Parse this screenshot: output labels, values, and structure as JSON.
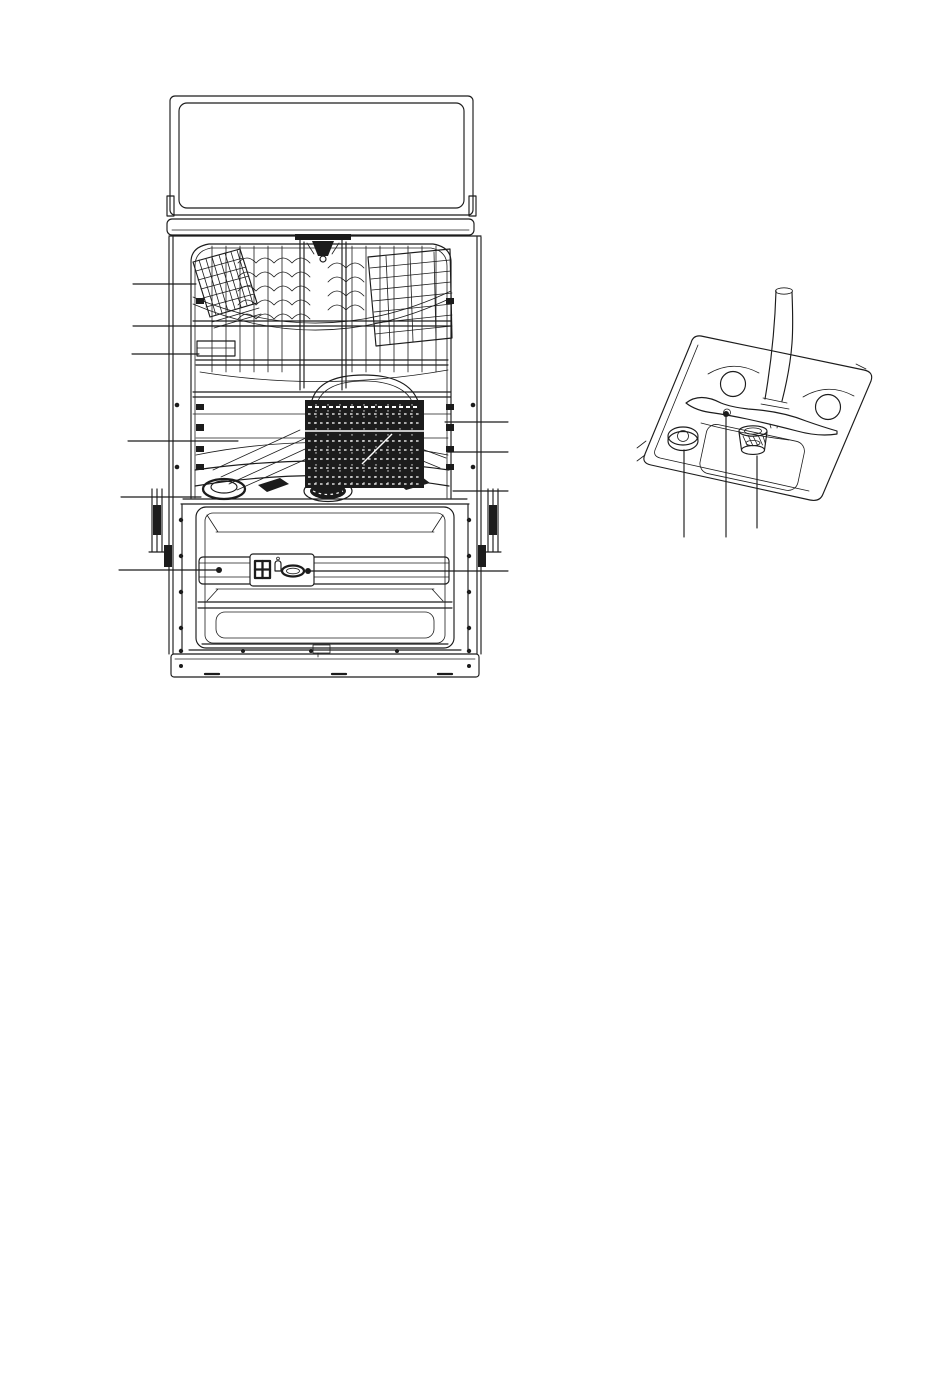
{
  "page": {
    "background": "#ffffff",
    "ink": "#1c1c1c",
    "width": 950,
    "height": 1392
  },
  "figures": {
    "main": {
      "id": "dishwasher-front-view-door-open",
      "parts": [
        "door-top-panel",
        "control-bar",
        "cabinet-sides",
        "tub",
        "top-spray-head",
        "upper-basket",
        "left-plate-rack",
        "right-plate-rack",
        "lower-basket",
        "cutlery-basket",
        "salt-container-cap",
        "filter-hub",
        "door-liner",
        "detergent-dispenser",
        "rinse-aid-cap",
        "plinth"
      ]
    },
    "detail": {
      "id": "sump-and-filter-detail",
      "parts": [
        "base-plate",
        "well-left",
        "well-right",
        "sump-recess",
        "lower-spray-arm",
        "water-inlet-pipe",
        "water-softener-cap",
        "filter-assembly"
      ]
    }
  },
  "callouts": [
    {
      "target": "upper-basket-cup-shelf",
      "from": [
        133,
        284
      ],
      "to": [
        196,
        284
      ]
    },
    {
      "target": "upper-basket-front-rail",
      "from": [
        133,
        326
      ],
      "to": [
        300,
        326
      ]
    },
    {
      "target": "upper-basket-plate-rack",
      "from": [
        132,
        354
      ],
      "to": [
        199,
        354
      ]
    },
    {
      "target": "lower-basket",
      "from": [
        128,
        441
      ],
      "to": [
        238,
        441
      ]
    },
    {
      "target": "salt-container-cap",
      "from": [
        121,
        497
      ],
      "to": [
        201,
        497
      ]
    },
    {
      "target": "detergent-dispenser",
      "from": [
        119,
        570
      ],
      "to": [
        219,
        570
      ],
      "dot": [
        219,
        570
      ]
    },
    {
      "target": "cutlery-basket",
      "from": [
        508,
        422
      ],
      "to": [
        445,
        422
      ]
    },
    {
      "target": "upper-basket-rail-right",
      "from": [
        508,
        452
      ],
      "to": [
        448,
        452
      ]
    },
    {
      "target": "lower-spray-arm-area",
      "from": [
        508,
        491
      ],
      "to": [
        453,
        491
      ]
    },
    {
      "target": "rinse-aid-dispenser",
      "from": [
        508,
        571
      ],
      "to": [
        308,
        571
      ],
      "dot": [
        308,
        571
      ]
    },
    {
      "target": "water-softener-cap-detail",
      "from": [
        684,
        450
      ],
      "to": [
        684,
        537
      ]
    },
    {
      "target": "lower-spray-arm-detail",
      "from": [
        726,
        416
      ],
      "to": [
        726,
        537
      ],
      "dot": [
        726,
        414
      ]
    },
    {
      "target": "filter-detail",
      "from": [
        757,
        456
      ],
      "to": [
        757,
        528
      ]
    }
  ]
}
